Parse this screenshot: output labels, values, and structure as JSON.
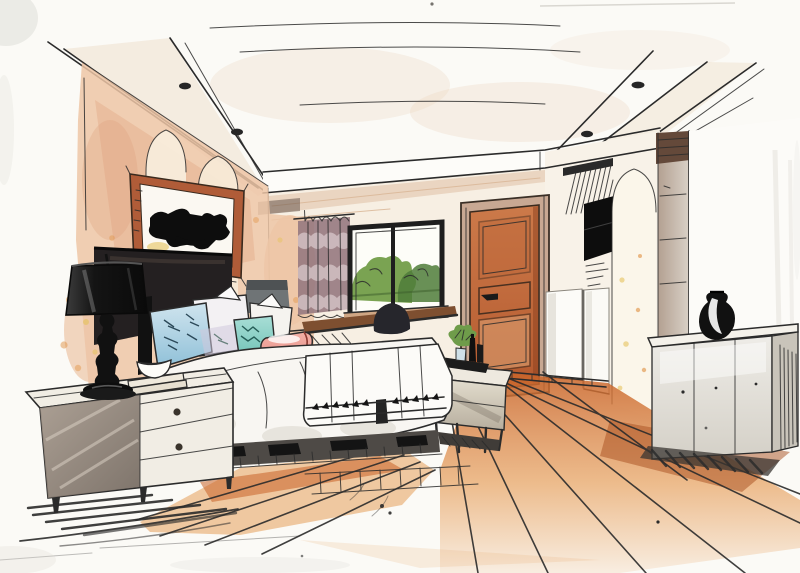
{
  "scene": {
    "title": "Hand-drawn interior design sketch of a bedroom in two-point perspective, marker and watercolor style",
    "room": "bedroom",
    "medium": "marker and watercolor sketch on white paper",
    "objects": [
      "tray ceiling with recessed spotlights",
      "left wall with pointed arch niches and mottled peach texture",
      "framed abstract artwork with black silhouette",
      "black drum-shade table lamp",
      "white dresser nightstand with two drawers",
      "glass bowl on books",
      "bed with white duvet",
      "light blue pillow",
      "white pillows",
      "teal pillow",
      "pink bolster cushion",
      "white throw with tassel border",
      "window with black frame and green shrubs outside",
      "striped mauve curtain",
      "desk console with dark chair",
      "small grey desk lamp",
      "terracotta panel door",
      "media wall with slatted vent and black TV",
      "white pointed arch niche",
      "grey-brown column cabinet",
      "long white console sideboard",
      "black round vase",
      "bench at foot of bed with tray, plant and bottles",
      "orange wood plank floor runner",
      "shadow hatching under furniture"
    ]
  },
  "palette": {
    "paper": "#fbfaf6",
    "ink": "#2b2b2b",
    "wall_peach": "#edc5a6",
    "wall_peach_deep": "#dfa07b",
    "speckle_orange": "#e09040",
    "speckle_yellow": "#e6c35e",
    "ceiling_wash": "#ead5bd",
    "soffit_tan": "#d9b696",
    "curtain_mauve": "#96797f",
    "curtain_light": "#d8c8cb",
    "window_green": "#7aa352",
    "window_green_dark": "#4f7c3a",
    "door_terracotta": "#cc7a4a",
    "door_terracotta_dark": "#b4592e",
    "door_panel_light": "#d89a6c",
    "door_frame_tan": "#c8a893",
    "floor_orange": "#c96328",
    "floor_orange_light": "#e8a668",
    "floor_orange_deep": "#a84e1e",
    "furniture_white": "#f1ede4",
    "furniture_grey": "#c9c4ba",
    "shade_grey_brown": "#8a7d71",
    "lamp_black": "#141414",
    "pillow_blue": "#8fc0d8",
    "pillow_blue_light": "#cfe4ee",
    "pillow_teal": "#6cc0b4",
    "pillow_pink": "#e89088",
    "desk_brown": "#7e4f30",
    "column_brown": "#b3a091",
    "column_cap": "#64493a",
    "plant_green": "#6f9c4a",
    "headboard_dark": "#242021",
    "frame_sienna": "#b05c38",
    "duvet_white": "#f8f6f2",
    "duvet_shadow": "#d8d3c9"
  }
}
